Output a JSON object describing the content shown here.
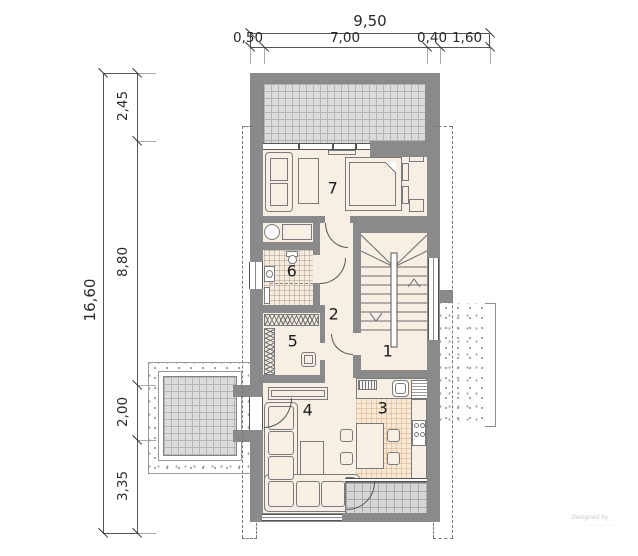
{
  "dimensions": {
    "top": {
      "total": "9,50",
      "seg1": "0,50",
      "seg2": "7,00",
      "seg3": "0,40",
      "seg4": "1,60"
    },
    "left": {
      "total": "16,60",
      "seg1": "2,45",
      "seg2": "8,80",
      "seg3": "2,00",
      "seg4": "3,35"
    }
  },
  "rooms": {
    "r1": "1",
    "r2": "2",
    "r3": "3",
    "r4": "4",
    "r5": "5",
    "r6": "6",
    "r7": "7"
  },
  "watermark": {
    "line1": "Designed by"
  },
  "colors": {
    "wall": "#8a8a8a",
    "floor": "#f8efe4",
    "terrace_hatch": "#dbdbdb",
    "kitchen_tile": "#f8e9d7"
  }
}
